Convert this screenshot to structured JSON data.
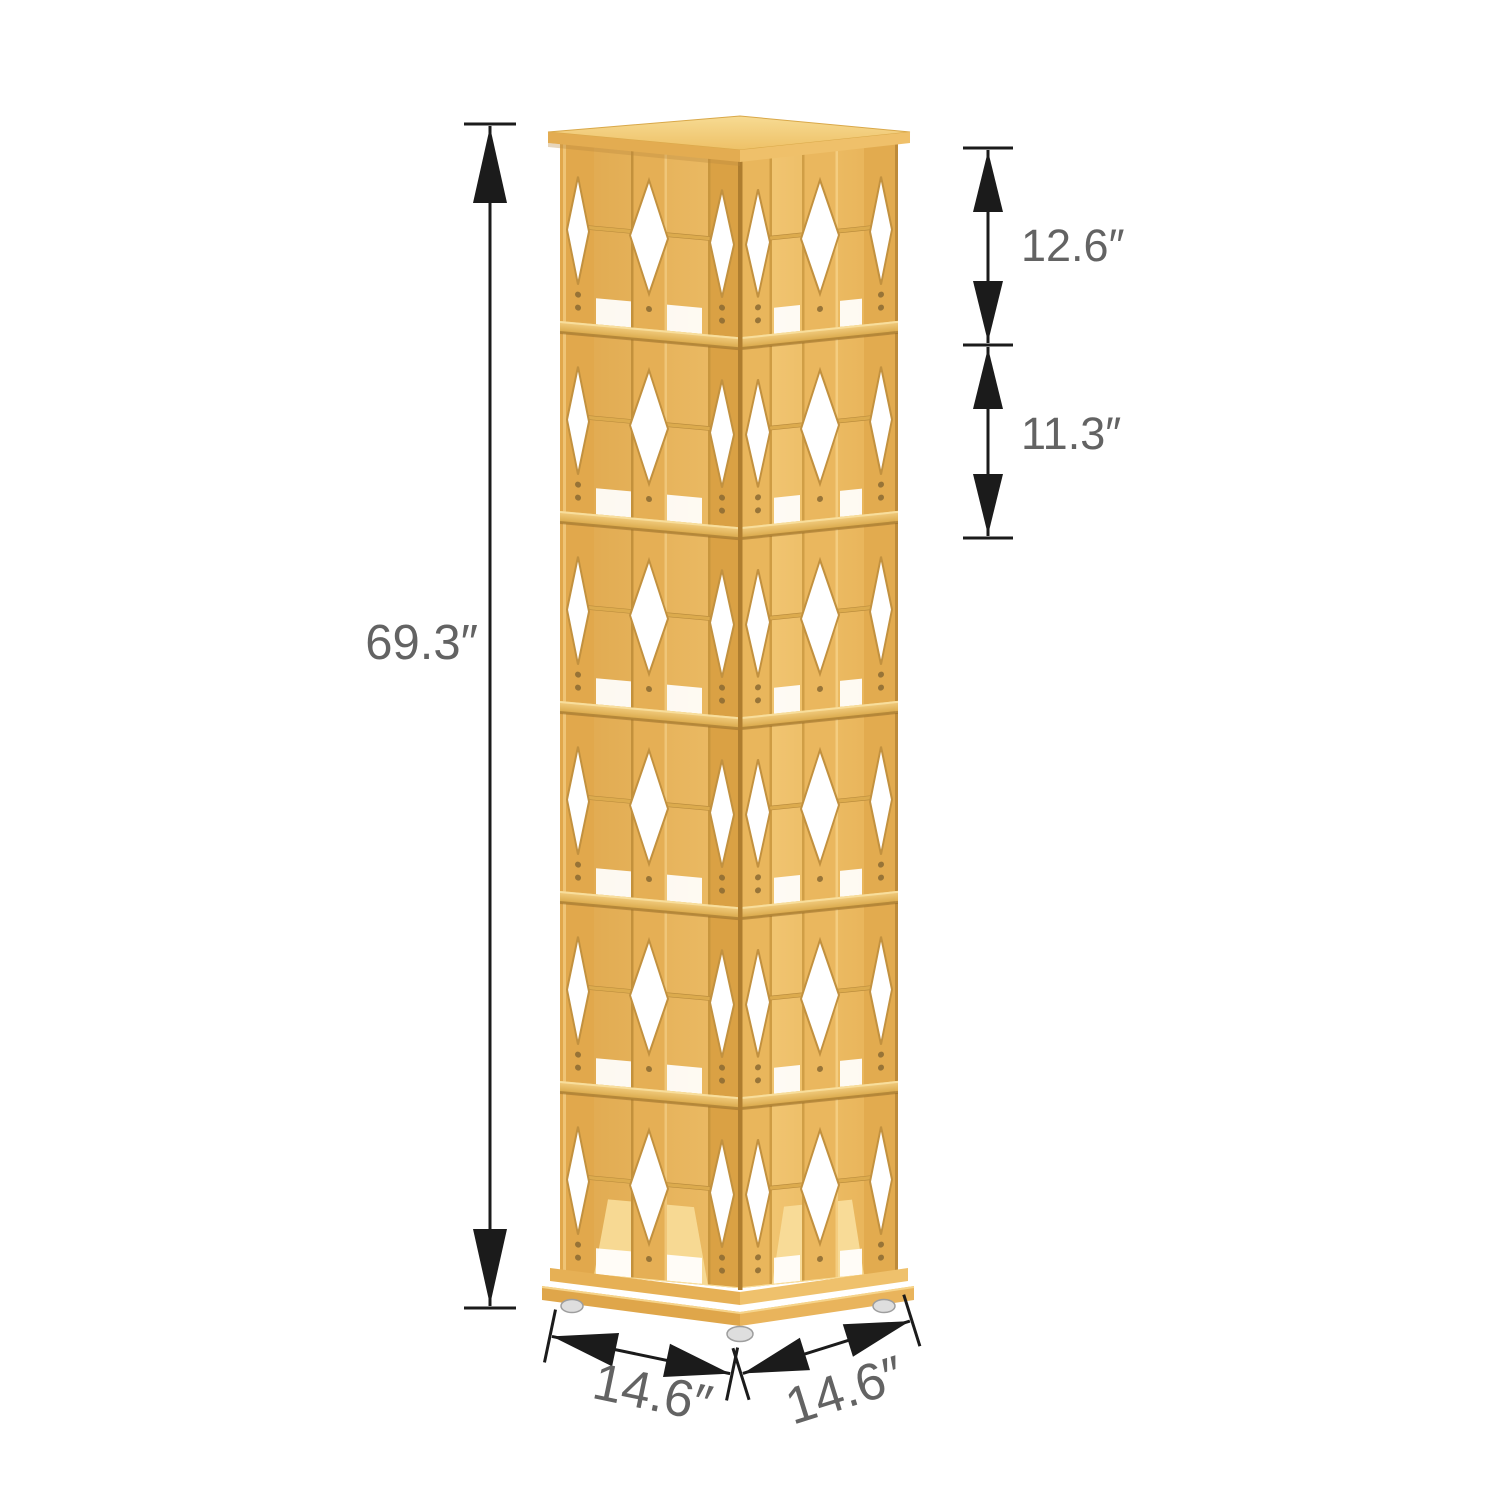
{
  "canvas": {
    "width": 1500,
    "height": 1500,
    "background": "#ffffff"
  },
  "illustration": {
    "subject": "six-tier rotating bamboo bookshelf tower with diamond cutout panels, viewed from a front corner, on a square rotating base with feet",
    "colors": {
      "bamboo_light": "#F3CB7C",
      "bamboo_mid": "#E6B158",
      "bamboo_dark": "#C79140",
      "cutout_white": "#FFFFFF",
      "foot_grey": "#DEDEDE"
    }
  },
  "dimensions": {
    "height": "69.3″",
    "top_section": "12.6″",
    "middle_section": "11.3″",
    "base_left": "14.6″",
    "base_right": "14.6″"
  },
  "annotation_style": {
    "line_color": "#1B1B1B",
    "label_color": "#636363"
  }
}
